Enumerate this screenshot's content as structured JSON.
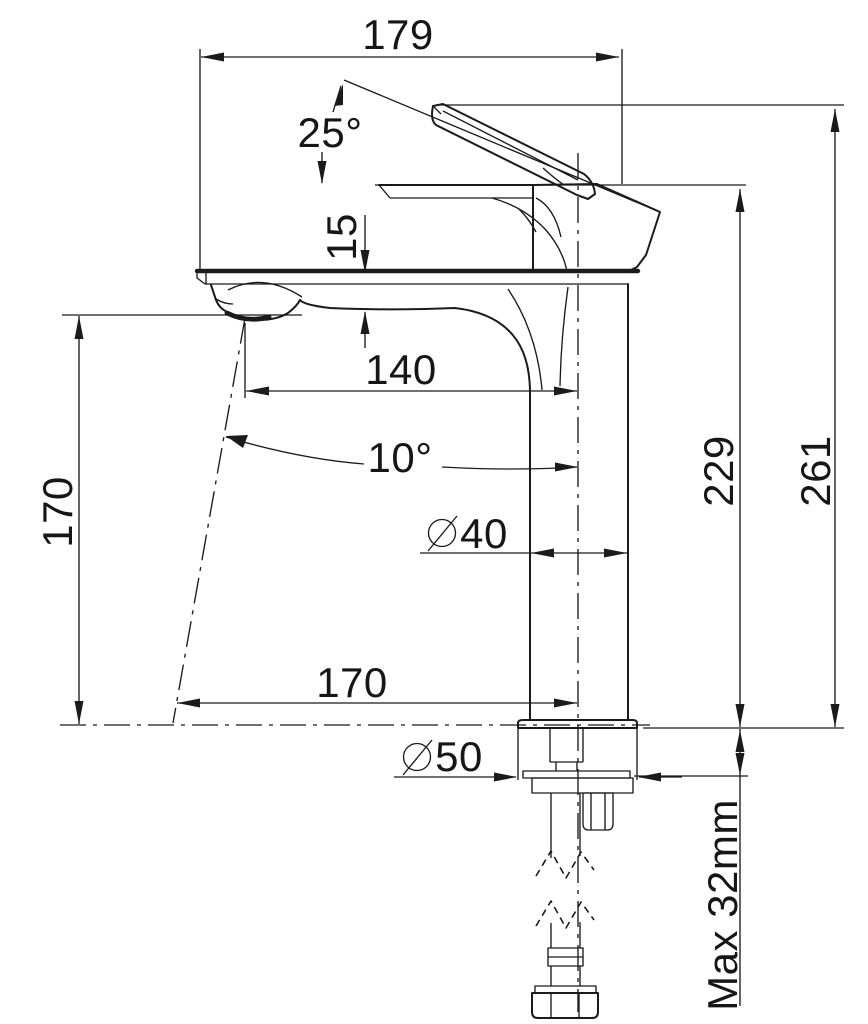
{
  "drawing": {
    "type": "faucet-dimension-drawing",
    "colors": {
      "line": "#1b1b1b",
      "background": "#ffffff"
    },
    "labels": {
      "overall_width": "179",
      "handle_angle": "25°",
      "spout_drop": "15",
      "spout_reach": "140",
      "stream_angle": "10°",
      "body_diameter_value": "40",
      "base_diameter_value": "50",
      "spout_outlet_height": "170",
      "reach_at_base": "170",
      "height_to_spout_top": "229",
      "overall_height": "261",
      "max_deck_thickness": "Max 32mm"
    }
  }
}
